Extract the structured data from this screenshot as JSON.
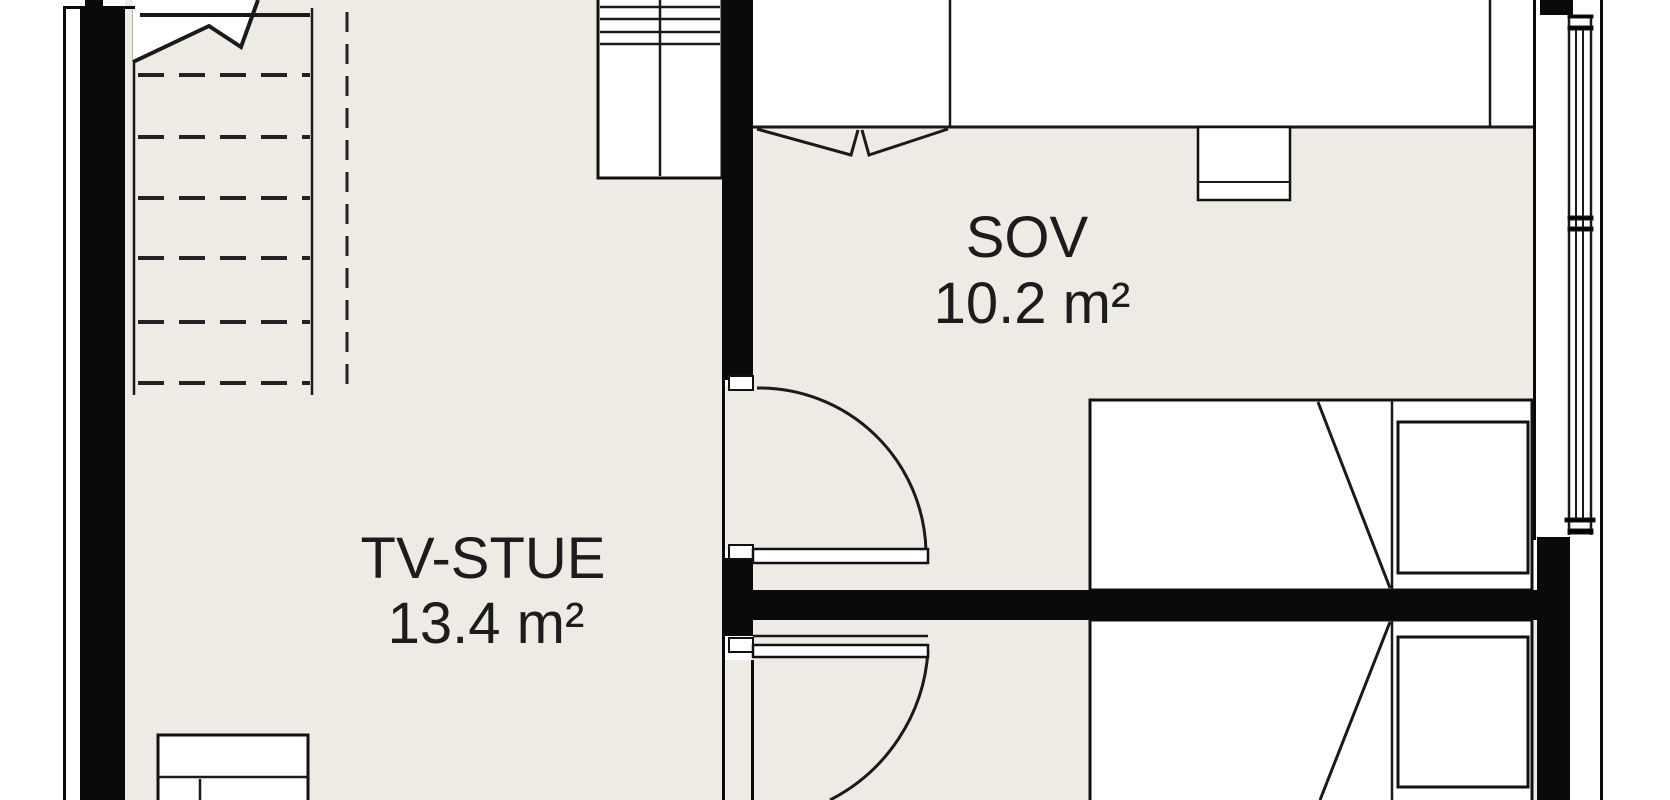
{
  "plan": {
    "rooms": [
      {
        "id": "sov",
        "name": "SOV",
        "area": "10.2 m²"
      },
      {
        "id": "tv-stue",
        "name": "TV-STUE",
        "area": "13.4 m²"
      }
    ]
  },
  "colors": {
    "floor": "#EDEBE3",
    "wall": "#0A0A0A",
    "line": "#1A1A1A",
    "paper": "#FFFFFF",
    "text": "#1C1C1C"
  }
}
